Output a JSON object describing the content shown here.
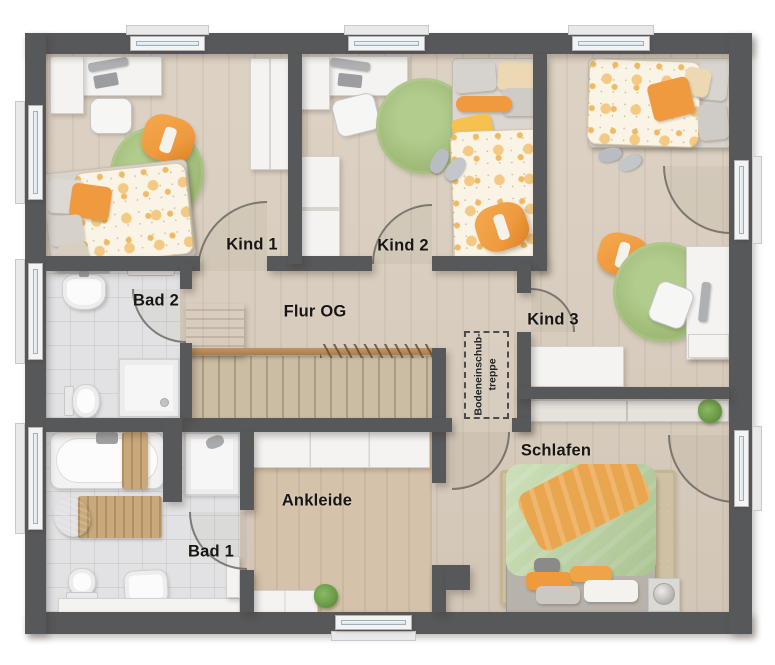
{
  "labels": {
    "kind1": "Kind 1",
    "kind2": "Kind 2",
    "kind3": "Kind 3",
    "bad2": "Bad 2",
    "bad1": "Bad 1",
    "flur": "Flur OG",
    "ankleide": "Ankleide",
    "schlafen": "Schlafen",
    "stair_line1": "Bodeneinschub-",
    "stair_line2": "treppe"
  },
  "rooms": [
    {
      "name": "Kind 1",
      "type": "children-bedroom"
    },
    {
      "name": "Kind 2",
      "type": "children-bedroom"
    },
    {
      "name": "Kind 3",
      "type": "children-bedroom"
    },
    {
      "name": "Bad 2",
      "type": "bathroom"
    },
    {
      "name": "Bad 1",
      "type": "bathroom"
    },
    {
      "name": "Flur OG",
      "type": "hallway-with-staircase"
    },
    {
      "name": "Ankleide",
      "type": "dressing-room"
    },
    {
      "name": "Schlafen",
      "type": "master-bedroom"
    }
  ],
  "colors": {
    "wall": "#57585a",
    "floor_wood": "#d9cdbd",
    "floor_tile": "#e2e2e4",
    "floor_ankleide": "#d5c2ab",
    "floor_stairs": "#cbbca4",
    "rug_green": "#a0bc78",
    "accent_orange": "#ef9a3f",
    "duvet_green": "#b8d29c",
    "furniture_wood": "#b8895c",
    "window_glass": "#d6e4ec"
  }
}
